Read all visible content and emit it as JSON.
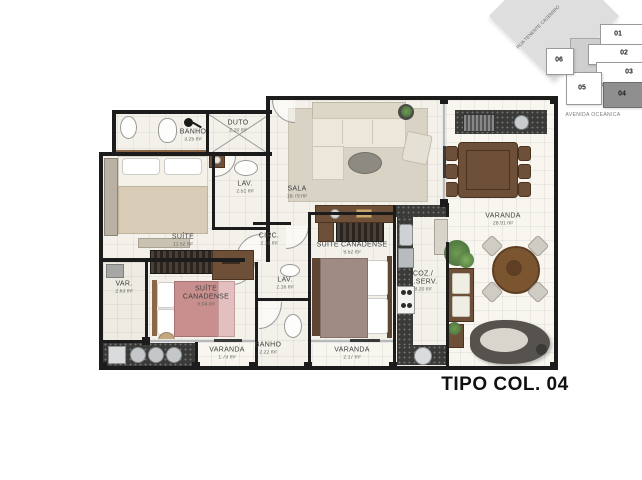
{
  "title": "TIPO COL. 04",
  "keyplan": {
    "street_diagonal": "RUA TENENTE CASEMIRO",
    "street_bottom": "AVENIDA OCEÂNICA",
    "units": [
      "01",
      "02",
      "03",
      "04",
      "05",
      "06"
    ],
    "highlighted_unit": "04"
  },
  "colors": {
    "wall": "#1c1c1c",
    "highlighted_unit_fill": "#8f8f8f"
  },
  "rooms": [
    {
      "name": "BANHO",
      "area": "3.25 m²"
    },
    {
      "name": "DUTO",
      "area": "2.10 m²"
    },
    {
      "name": "LAV.",
      "area": "2.51 m²"
    },
    {
      "name": "SALA",
      "area": "18.79 m²"
    },
    {
      "name": "SUÍTE",
      "area": "11.52 m²"
    },
    {
      "name": "CIRC.",
      "area": "2.13 m²"
    },
    {
      "name": "SUÍTE CANADENSE",
      "area": "9.52 m²"
    },
    {
      "name": "VAR.",
      "area": "2.63 m²"
    },
    {
      "name": "SUÍTE CANADENSE",
      "area": "9.04 m²"
    },
    {
      "name": "LAV.",
      "area": "2.16 m²"
    },
    {
      "name": "COZ./ A.SERV.",
      "area": "8.20 m²"
    },
    {
      "name": "VARANDA",
      "area": "28.91 m²"
    },
    {
      "name": "VARANDA",
      "area": "1.73 m²"
    },
    {
      "name": "BANHO",
      "area": "2.22 m²"
    },
    {
      "name": "VARANDA",
      "area": "2.17 m²"
    }
  ]
}
